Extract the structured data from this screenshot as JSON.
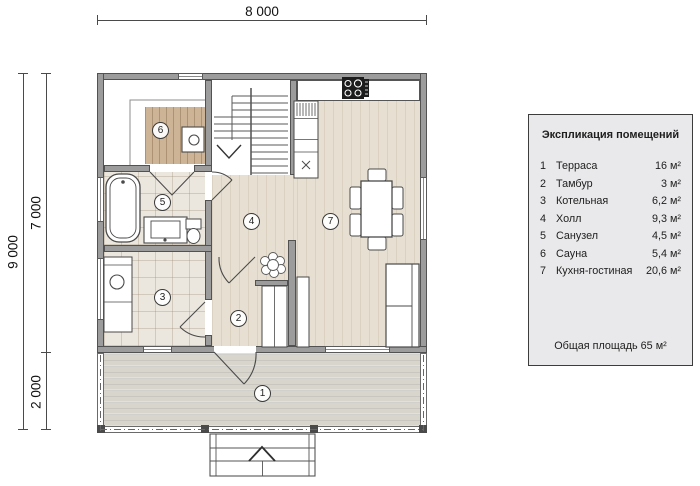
{
  "dimensions": {
    "top": "8 000",
    "left_total": "9 000",
    "left_main": "7 000",
    "left_terrace": "2 000"
  },
  "markers": [
    "1",
    "2",
    "3",
    "4",
    "5",
    "6",
    "7"
  ],
  "legend": {
    "title": "Экспликация помещений",
    "rows": [
      {
        "num": "1",
        "name": "Терраса",
        "area": "16 м²"
      },
      {
        "num": "2",
        "name": "Тамбур",
        "area": "3 м²"
      },
      {
        "num": "3",
        "name": "Котельная",
        "area": "6,2 м²"
      },
      {
        "num": "4",
        "name": "Холл",
        "area": "9,3 м²"
      },
      {
        "num": "5",
        "name": "Санузел",
        "area": "4,5 м²"
      },
      {
        "num": "6",
        "name": "Сауна",
        "area": "5,4 м²"
      },
      {
        "num": "7",
        "name": "Кухня-гостиная",
        "area": "20,6 м²"
      }
    ],
    "total": "Общая площадь 65 м²"
  },
  "colors": {
    "wall": "#9c9c9c",
    "wood_floor": "#e7e0d2",
    "sauna_floor": "#cdb496",
    "tile_floor": "#ece7de",
    "terrace_floor": "#d8d5cd",
    "legend_bg": "#e9e9eb"
  }
}
